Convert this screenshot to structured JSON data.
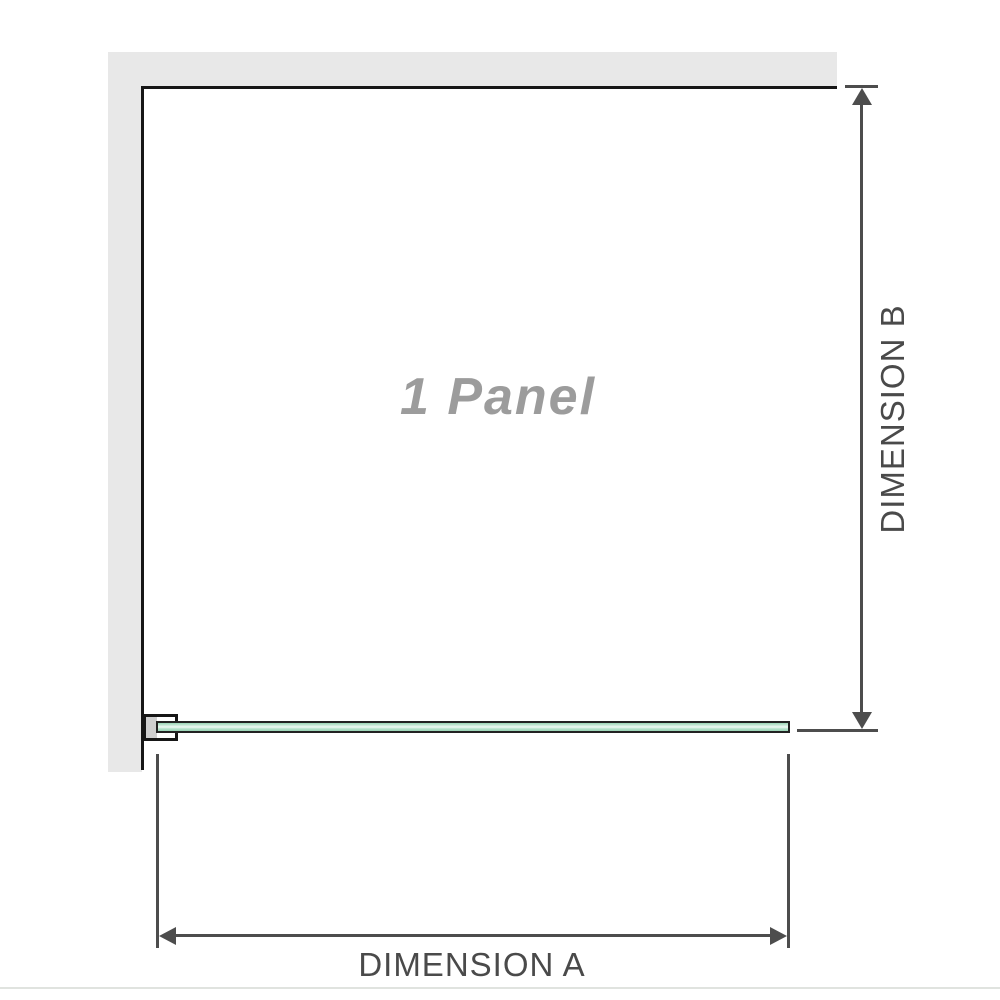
{
  "diagram": {
    "panel_label": "1 Panel",
    "dimension_a_label": "DIMENSION A",
    "dimension_b_label": "DIMENSION B"
  },
  "colors": {
    "wall_gray": "#e8e8e8",
    "outline_black": "#161616",
    "glass_green": "#98d4b5",
    "glass_highlight": "#f0faf4",
    "bracket_pad_gray": "#cfcfcf",
    "dimension_line_gray": "#4d4d4d",
    "label_text_gray": "#4a4a4a",
    "panel_label_gray": "#9c9c9c",
    "baseline_gray": "#e0e3df"
  }
}
